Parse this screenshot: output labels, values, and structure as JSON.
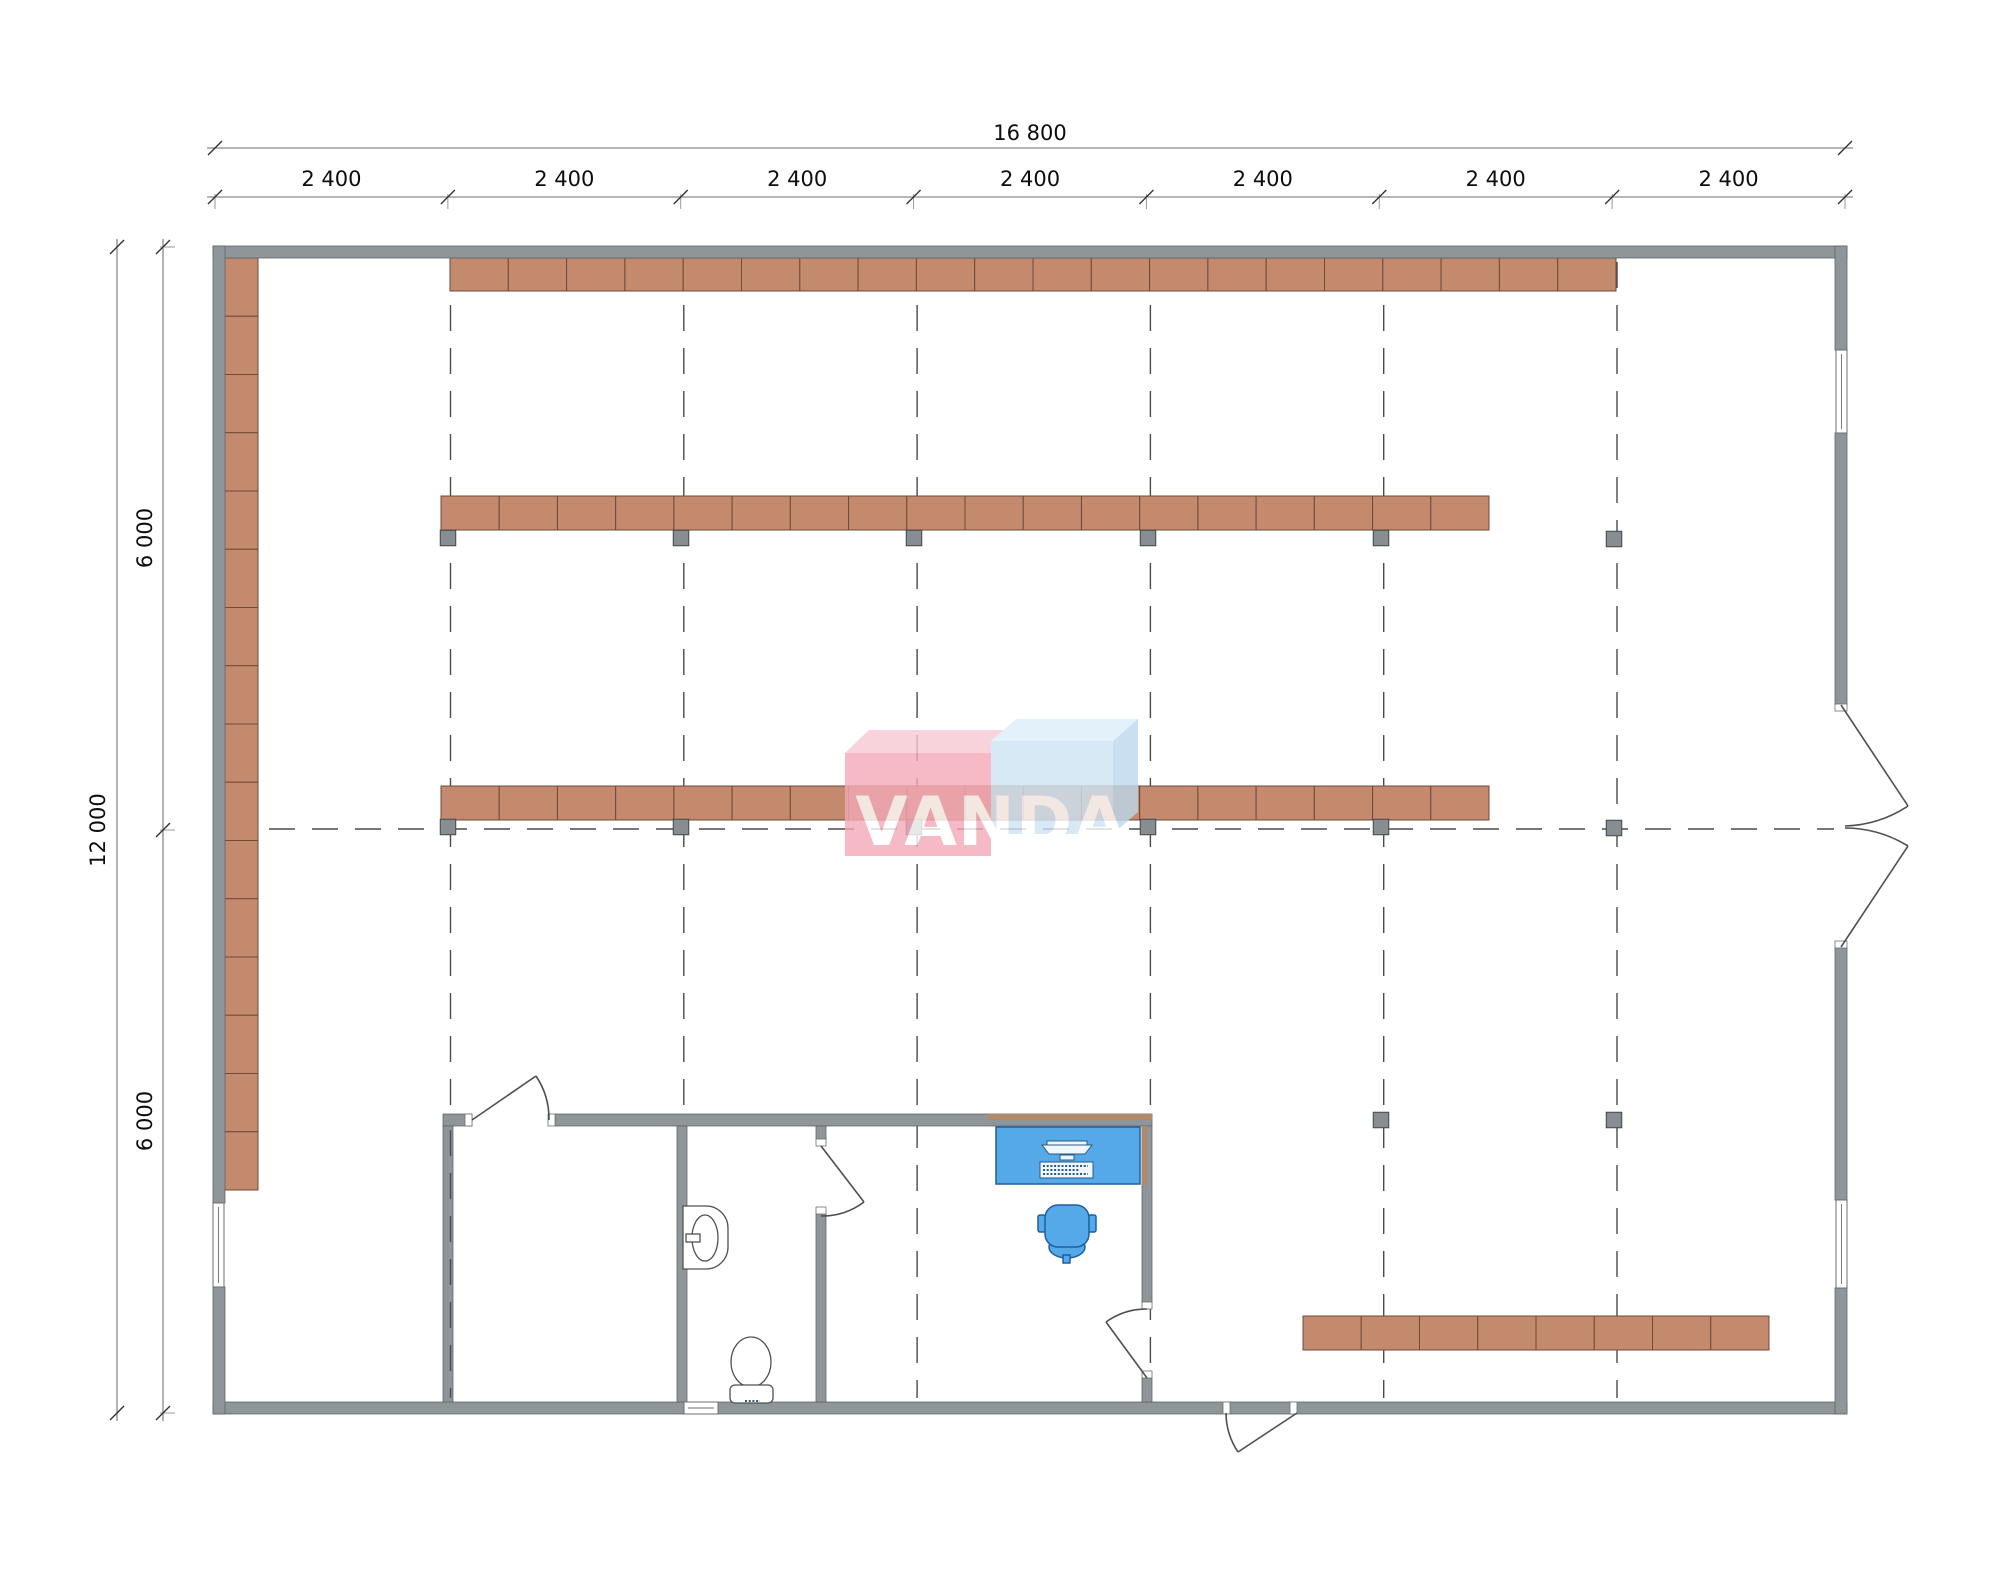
{
  "watermark": {
    "text": "VANDA"
  },
  "dimensions": {
    "top_overall": "16 800",
    "top_bay": "2 400",
    "top_bay_count": 7,
    "left_overall": "12 000",
    "left_half": "6 000"
  },
  "colors": {
    "wall": "#8f9699",
    "shelf": "#c38a6d",
    "column": "#878d90",
    "furniture_blue": "#55a9e8",
    "logo_pink": "#f4a9b8",
    "logo_pink_top": "#f8c9d3",
    "logo_blue": "#cfe4f4",
    "logo_blue_top": "#ddeefa",
    "logo_blue_side": "#bdd8ec",
    "grid_dash": "#4a4a4a"
  },
  "grid": {
    "verticals": [
      450.5,
      683.8,
      917.1,
      1150.4,
      1383.7,
      1617.0
    ],
    "v_y": [
      262,
      1398
    ],
    "horizontal_y": 829,
    "h_x": [
      226,
      1834
    ]
  },
  "shelving": {
    "rows": [
      {
        "x": 450,
        "y": 258,
        "w": 1166,
        "h": 33,
        "segs": 20
      },
      {
        "x": 441,
        "y": 496,
        "w": 1048,
        "h": 34,
        "segs": 18
      },
      {
        "x": 441,
        "y": 786,
        "w": 1048,
        "h": 34,
        "segs": 18
      },
      {
        "x": 1303,
        "y": 1316,
        "w": 466,
        "h": 34,
        "segs": 8
      }
    ],
    "left_strip": {
      "x": 224,
      "y": 258,
      "w": 34,
      "h": 932,
      "segs": 16
    }
  },
  "columns": {
    "size": 15.5,
    "positions": [
      [
        448,
        538
      ],
      [
        681,
        538
      ],
      [
        914,
        538
      ],
      [
        1148,
        538
      ],
      [
        1381,
        538
      ],
      [
        1614,
        539
      ],
      [
        448,
        827
      ],
      [
        681,
        827
      ],
      [
        914,
        827
      ],
      [
        1148,
        827
      ],
      [
        1381,
        827
      ],
      [
        1614,
        828
      ],
      [
        1381,
        1120
      ],
      [
        1614,
        1120
      ]
    ]
  },
  "dim_geom": {
    "left_x": 215,
    "right_x": 1845,
    "top_line_y": 148,
    "bay_line_y": 197,
    "bay_label_y": 186,
    "outer_x": 117,
    "inner_x": 163,
    "top_y": 247,
    "mid_y": 830,
    "bottom_y": 1413
  }
}
